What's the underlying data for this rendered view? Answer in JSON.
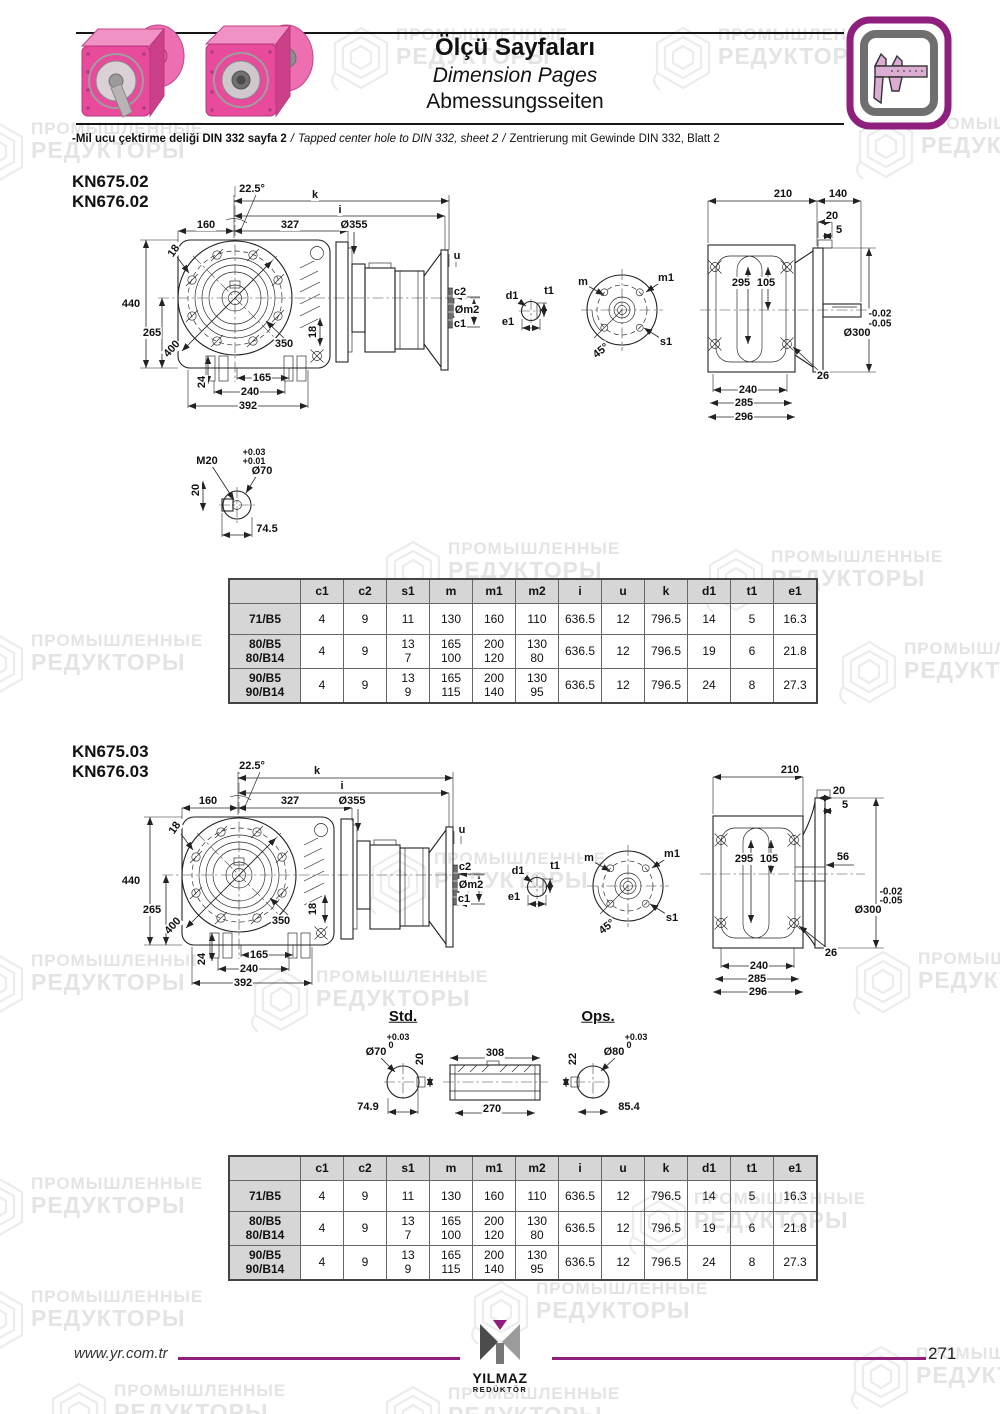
{
  "header": {
    "title_tr": "Ölçü Sayfaları",
    "title_en": "Dimension Pages",
    "title_de": "Abmessungsseiten",
    "note_tr": "-Mil ucu çektirme deliği DIN 332 sayfa 2",
    "note_sep": "/",
    "note_en": "Tapped center hole to DIN 332, sheet 2",
    "note_de": "Zentrierung mit Gewinde DIN 332, Blatt 2"
  },
  "watermark": {
    "line1": "ПРОМЫШЛЕННЫЕ",
    "line2": "РЕДУКТОРЫ"
  },
  "accent_color": "#8e1f7c",
  "sections": [
    {
      "models": [
        "KN675.02",
        "KN676.02"
      ],
      "labels": [
        {
          "t": "22.5°",
          "x": 252,
          "y": 19
        },
        {
          "t": "k",
          "x": 315,
          "y": 25
        },
        {
          "t": "i",
          "x": 340,
          "y": 40
        },
        {
          "t": "160",
          "x": 206,
          "y": 55
        },
        {
          "t": "327",
          "x": 290,
          "y": 55
        },
        {
          "t": "Ø355",
          "x": 354,
          "y": 55
        },
        {
          "t": "18",
          "x": 174,
          "y": 81,
          "r": -55
        },
        {
          "t": "440",
          "x": 131,
          "y": 134
        },
        {
          "t": "265",
          "x": 152,
          "y": 163
        },
        {
          "t": "400",
          "x": 172,
          "y": 179,
          "r": -48
        },
        {
          "t": "350",
          "x": 284,
          "y": 174
        },
        {
          "t": "24",
          "x": 202,
          "y": 212,
          "r": -90
        },
        {
          "t": "165",
          "x": 262,
          "y": 208
        },
        {
          "t": "240",
          "x": 250,
          "y": 222
        },
        {
          "t": "392",
          "x": 248,
          "y": 236
        },
        {
          "t": "18",
          "x": 313,
          "y": 162,
          "r": -90
        },
        {
          "t": "u",
          "x": 457,
          "y": 86
        },
        {
          "t": "c2",
          "x": 460,
          "y": 122
        },
        {
          "t": "Øm2",
          "x": 467,
          "y": 140
        },
        {
          "t": "c1",
          "x": 460,
          "y": 154
        },
        {
          "t": "d1",
          "x": 512,
          "y": 126
        },
        {
          "t": "t1",
          "x": 549,
          "y": 121
        },
        {
          "t": "e1",
          "x": 508,
          "y": 152
        },
        {
          "t": "m",
          "x": 583,
          "y": 112
        },
        {
          "t": "m1",
          "x": 666,
          "y": 108
        },
        {
          "t": "s1",
          "x": 666,
          "y": 172
        },
        {
          "t": "45°",
          "x": 601,
          "y": 181,
          "r": -38
        },
        {
          "t": "210",
          "x": 783,
          "y": 24
        },
        {
          "t": "140",
          "x": 838,
          "y": 24
        },
        {
          "t": "20",
          "x": 832,
          "y": 46
        },
        {
          "t": "5",
          "x": 839,
          "y": 60
        },
        {
          "t": "295",
          "x": 741,
          "y": 113
        },
        {
          "t": "105",
          "x": 766,
          "y": 113
        },
        {
          "t": "-0.02",
          "x": 880,
          "y": 144,
          "fs": 10
        },
        {
          "t": "-0.05",
          "x": 880,
          "y": 154,
          "fs": 10
        },
        {
          "t": "Ø300",
          "x": 857,
          "y": 163
        },
        {
          "t": "26",
          "x": 823,
          "y": 206
        },
        {
          "t": "240",
          "x": 748,
          "y": 220
        },
        {
          "t": "285",
          "x": 744,
          "y": 233
        },
        {
          "t": "296",
          "x": 744,
          "y": 247
        },
        {
          "t": "M20",
          "x": 207,
          "y": 291
        },
        {
          "t": "+0.03",
          "x": 254,
          "y": 283,
          "fs": 9
        },
        {
          "t": "+0.01",
          "x": 254,
          "y": 292,
          "fs": 9
        },
        {
          "t": "Ø70",
          "x": 262,
          "y": 301
        },
        {
          "t": "20",
          "x": 196,
          "y": 320,
          "r": -90
        },
        {
          "t": "74.5",
          "x": 267,
          "y": 359
        }
      ]
    },
    {
      "models": [
        "KN675.03",
        "KN676.03"
      ],
      "labels": [
        {
          "t": "22.5°",
          "x": 252,
          "y": 26
        },
        {
          "t": "k",
          "x": 317,
          "y": 31
        },
        {
          "t": "i",
          "x": 342,
          "y": 46
        },
        {
          "t": "160",
          "x": 208,
          "y": 61
        },
        {
          "t": "327",
          "x": 290,
          "y": 61
        },
        {
          "t": "Ø355",
          "x": 352,
          "y": 61
        },
        {
          "t": "18",
          "x": 175,
          "y": 88,
          "r": -55
        },
        {
          "t": "440",
          "x": 131,
          "y": 141
        },
        {
          "t": "265",
          "x": 152,
          "y": 170
        },
        {
          "t": "400",
          "x": 173,
          "y": 186,
          "r": -48
        },
        {
          "t": "350",
          "x": 281,
          "y": 181
        },
        {
          "t": "24",
          "x": 202,
          "y": 219,
          "r": -90
        },
        {
          "t": "165",
          "x": 259,
          "y": 215
        },
        {
          "t": "240",
          "x": 249,
          "y": 229
        },
        {
          "t": "392",
          "x": 243,
          "y": 243
        },
        {
          "t": "18",
          "x": 313,
          "y": 169,
          "r": -90
        },
        {
          "t": "u",
          "x": 462,
          "y": 90
        },
        {
          "t": "c2",
          "x": 465,
          "y": 127
        },
        {
          "t": "Øm2",
          "x": 471,
          "y": 145
        },
        {
          "t": "c1",
          "x": 464,
          "y": 159
        },
        {
          "t": "d1",
          "x": 518,
          "y": 131
        },
        {
          "t": "t1",
          "x": 555,
          "y": 126
        },
        {
          "t": "e1",
          "x": 514,
          "y": 157
        },
        {
          "t": "m",
          "x": 589,
          "y": 118
        },
        {
          "t": "m1",
          "x": 672,
          "y": 114
        },
        {
          "t": "s1",
          "x": 672,
          "y": 178
        },
        {
          "t": "45°",
          "x": 607,
          "y": 187,
          "r": -38
        },
        {
          "t": "210",
          "x": 790,
          "y": 30
        },
        {
          "t": "20",
          "x": 839,
          "y": 51
        },
        {
          "t": "5",
          "x": 845,
          "y": 65
        },
        {
          "t": "295",
          "x": 744,
          "y": 119
        },
        {
          "t": "105",
          "x": 769,
          "y": 119
        },
        {
          "t": "56",
          "x": 843,
          "y": 117
        },
        {
          "t": "-0.02",
          "x": 891,
          "y": 152,
          "fs": 10
        },
        {
          "t": "-0.05",
          "x": 891,
          "y": 161,
          "fs": 10
        },
        {
          "t": "Ø300",
          "x": 868,
          "y": 170
        },
        {
          "t": "26",
          "x": 831,
          "y": 213
        },
        {
          "t": "240",
          "x": 759,
          "y": 226
        },
        {
          "t": "285",
          "x": 757,
          "y": 239
        },
        {
          "t": "296",
          "x": 758,
          "y": 252
        },
        {
          "t": "Std.",
          "x": 403,
          "y": 277,
          "fs": 15,
          "u": 1,
          "n": "std-label"
        },
        {
          "t": "Ops.",
          "x": 598,
          "y": 277,
          "fs": 15,
          "u": 1,
          "n": "ops-label"
        },
        {
          "t": "Ø70",
          "x": 376,
          "y": 312
        },
        {
          "t": "+0.03",
          "x": 398,
          "y": 298,
          "fs": 9
        },
        {
          "t": "0",
          "x": 391,
          "y": 306,
          "fs": 9
        },
        {
          "t": "20",
          "x": 420,
          "y": 319,
          "r": -90
        },
        {
          "t": "74.9",
          "x": 368,
          "y": 367
        },
        {
          "t": "308",
          "x": 495,
          "y": 313
        },
        {
          "t": "270",
          "x": 492,
          "y": 369
        },
        {
          "t": "Ø80",
          "x": 614,
          "y": 312
        },
        {
          "t": "+0.03",
          "x": 636,
          "y": 298,
          "fs": 9
        },
        {
          "t": "0",
          "x": 629,
          "y": 306,
          "fs": 9
        },
        {
          "t": "22",
          "x": 573,
          "y": 319,
          "r": -90
        },
        {
          "t": "85.4",
          "x": 629,
          "y": 367
        }
      ]
    }
  ],
  "table": {
    "headers": [
      "",
      "c1",
      "c2",
      "s1",
      "m",
      "m1",
      "m2",
      "i",
      "u",
      "k",
      "d1",
      "t1",
      "e1"
    ],
    "rows": [
      {
        "label": "71/B5",
        "values": [
          "4",
          "9",
          "11",
          "130",
          "160",
          "110",
          "636.5",
          "12",
          "796.5",
          "14",
          "5",
          "16.3"
        ]
      },
      {
        "label": "80/B5\n80/B14",
        "values": [
          "4",
          "9",
          "13\n7",
          "165\n100",
          "200\n120",
          "130\n80",
          "636.5",
          "12",
          "796.5",
          "19",
          "6",
          "21.8"
        ]
      },
      {
        "label": "90/B5\n90/B14",
        "values": [
          "4",
          "9",
          "13\n9",
          "165\n115",
          "200\n140",
          "130\n95",
          "636.5",
          "12",
          "796.5",
          "24",
          "8",
          "27.3"
        ]
      }
    ]
  },
  "footer": {
    "website": "www.yr.com.tr",
    "page_number": "271",
    "logo_line1": "YILMAZ",
    "logo_line2": "REDÜKTÖR"
  }
}
